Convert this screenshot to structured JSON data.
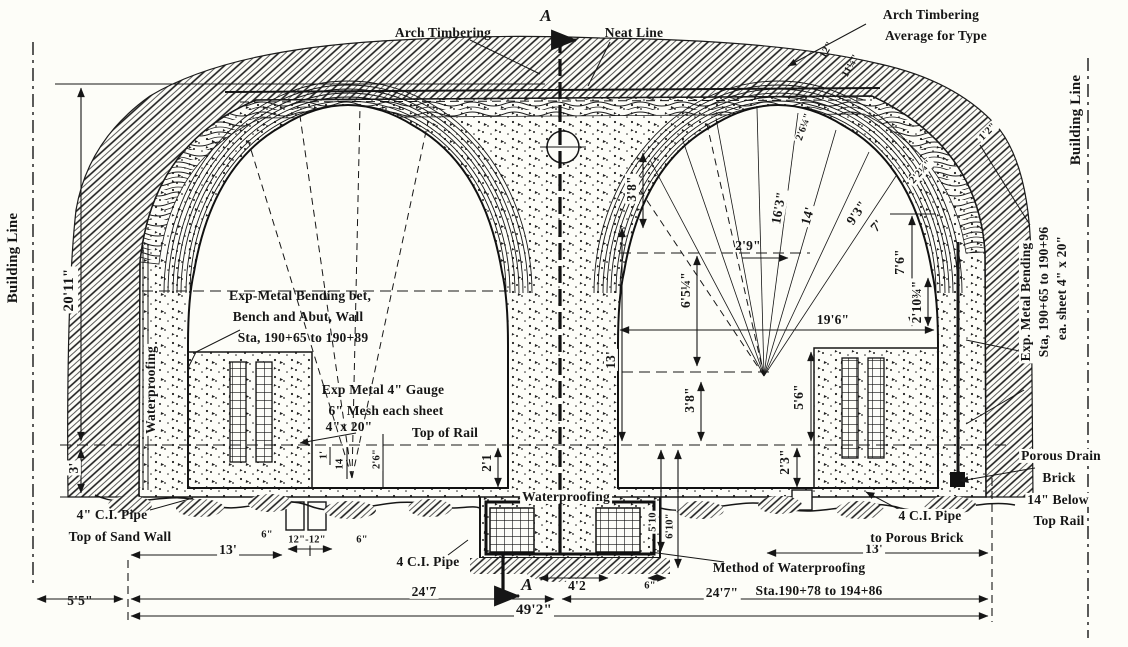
{
  "page": {
    "paper_color": "#fdfdf8",
    "ink_color": "#161616"
  },
  "drawing": {
    "type": "tunnel-cross-section",
    "top": {
      "arch_timbering": "Arch Timbering",
      "section_a_top": "A",
      "neat_line": "Neat Line",
      "arch_avg_1": "Arch Timbering",
      "arch_avg_2": "Average for Type",
      "small_12": "12\"",
      "small_11": "11¼\"",
      "small_2_6": "2'6¼\"",
      "small_2_2": "2'2¼\"",
      "small_1_2": "1'2\""
    },
    "left": {
      "building_line": "Building Line",
      "dim_20_11": "20'11\"",
      "dim_3": "3'",
      "waterproofing": "Waterproofing",
      "ci_pipe": "4\" C.I. Pipe",
      "top_of_sand_wall": "Top of Sand Wall"
    },
    "right": {
      "building_line": "Building Line",
      "exp_metal_1": "Exp. Metal Bending",
      "exp_metal_2": "Sta, 190+65 to 190+96",
      "exp_metal_3": "ea. sheet 4\" x 20\"",
      "porous_1": "Porous Drain",
      "porous_2": "Brick",
      "porous_3": "14\" Below",
      "porous_4": "Top Rail"
    },
    "interior_left": {
      "exp_bending_1": "Exp-Metal Bending bet,",
      "exp_bending_2": "Bench and Abut, Wall",
      "exp_bending_3": "Sta, 190+65 to 190+89",
      "gauge_1": "Exp Metal 4\" Gauge",
      "gauge_2": "6\" Mesh each sheet",
      "gauge_3": "4\"x 20\"",
      "top_of_rail": "Top of Rail",
      "dim_1": "1'",
      "dim_14": "14",
      "dim_2_6": "2'6\"",
      "dim_2_1": "2'1"
    },
    "interior_right": {
      "dim_3_8_top": "3'8\"",
      "dim_2_9": "2'9\"",
      "dim_6_5": "6'5¼\"",
      "dim_16_3": "16'3\"",
      "dim_14": "14'",
      "dim_9_3": "9'3\"",
      "dim_7": "7'",
      "dim_7_6": "7'6\"",
      "dim_2_10": "2'10¾\"",
      "dim_19_6": "19'6\"",
      "dim_13": "13'",
      "dim_3_8": "3'8\"",
      "dim_5_6": "5'6\"",
      "dim_2_3": "2'3\""
    },
    "bottom": {
      "dim_5_5": "5'5\"",
      "dim_13_left": "13'",
      "dim_6_left": "6\"",
      "dim_12_12": "12\"-12\"",
      "dim_6_right": "6\"",
      "ci_pipe": "4 C.I. Pipe",
      "dim_24_7_left": "24'7",
      "dim_49_2": "49'2\"",
      "section_a_bottom": "A",
      "dim_4_2": "4'2",
      "dim_6_pit": "6\"",
      "dim_5_10": "5'10",
      "dim_6_10": "6'10\"",
      "waterproofing": "Waterproofing",
      "method_1": "Method of Waterproofing",
      "method_2": "Sta.190+78 to 194+86",
      "dim_24_7_right": "24'7\"",
      "dim_13_right": "13'",
      "ci_porous_1": "4 C.I. Pipe",
      "ci_porous_2": "to Porous Brick"
    }
  }
}
